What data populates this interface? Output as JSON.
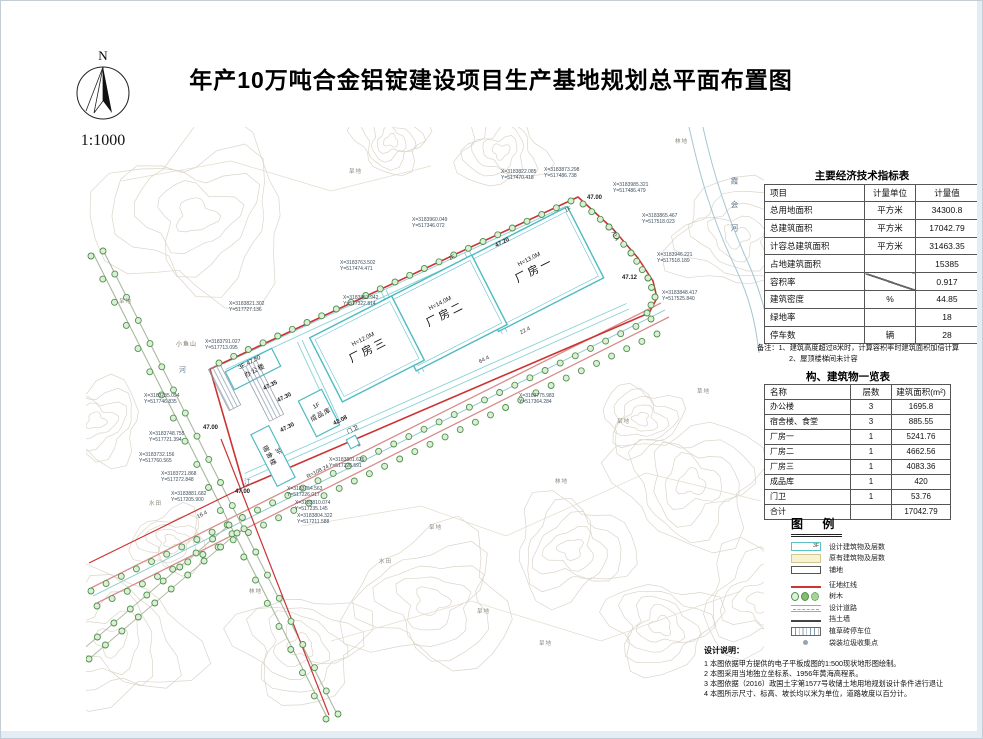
{
  "title": "年产10万吨合金铝锭建设项目生产基地规划总平面布置图",
  "compass": {
    "north_label": "N",
    "scale": "1:1000"
  },
  "econ_table": {
    "title": "主要经济技术指标表",
    "headers": [
      "项目",
      "计量单位",
      "计量值"
    ],
    "rows": [
      {
        "name": "总用地面积",
        "unit": "平方米",
        "value": "34300.8"
      },
      {
        "name": "总建筑面积",
        "unit": "平方米",
        "value": "17042.79"
      },
      {
        "name": "计容总建筑面积",
        "unit": "平方米",
        "value": "31463.35"
      },
      {
        "name": "占地建筑面积",
        "unit": "",
        "value": "15385"
      },
      {
        "name": "容积率",
        "unit": "DIAG",
        "value": "0.917"
      },
      {
        "name": "建筑密度",
        "unit": "%",
        "value": "44.85"
      },
      {
        "name": "绿地率",
        "unit": "",
        "value": "18"
      },
      {
        "name": "停车数",
        "unit": "辆",
        "value": "28"
      }
    ],
    "notes": [
      "备注：1、建筑高度超过8米时，计算容积率时建筑面积加倍计算",
      "2、屋顶楼梯间未计容"
    ]
  },
  "building_table": {
    "title": "构、建筑物一览表",
    "headers": [
      "名称",
      "层数",
      "建筑面积(m²)"
    ],
    "rows": [
      {
        "name": "办公楼",
        "floors": "3",
        "area": "1695.8"
      },
      {
        "name": "宿舍楼、食堂",
        "floors": "3",
        "area": "885.55"
      },
      {
        "name": "厂房一",
        "floors": "1",
        "area": "5241.76"
      },
      {
        "name": "厂房二",
        "floors": "1",
        "area": "4662.56"
      },
      {
        "name": "厂房三",
        "floors": "1",
        "area": "4083.36"
      },
      {
        "name": "成品库",
        "floors": "1",
        "area": "420"
      },
      {
        "name": "门卫",
        "floors": "1",
        "area": "53.76"
      },
      {
        "name": "合计",
        "floors": "",
        "area": "17042.79"
      }
    ]
  },
  "legend": {
    "title": "图 例",
    "items": [
      {
        "label": "设计建筑物及层数",
        "swatch_text": "3F"
      },
      {
        "label": "原有建筑物及层数"
      },
      {
        "label": "铺地"
      },
      {
        "label": "征地红线"
      },
      {
        "label": "树木"
      },
      {
        "label": "设计道路"
      },
      {
        "label": "挡土墙"
      },
      {
        "label": "植草砖停车位"
      },
      {
        "label": "袋装垃圾收集点"
      }
    ]
  },
  "notes": {
    "title": "设计说明：",
    "lines": [
      "1 本图依据甲方提供的电子平板成图的1:500现状地形图绘制。",
      "2 本图采用当地独立坐标系、1956年黄海高程系。",
      "3 本图依据（2016）政国土字第1577号收储土地用地规划设计条件进行退让",
      "4 本图所示尺寸、标高、坡长均以米为单位，道路坡度以百分计。"
    ]
  },
  "plan": {
    "buildings": [
      {
        "name": "厂房一",
        "height": "H=13.0M"
      },
      {
        "name": "厂房二",
        "height": "H=14.0M"
      },
      {
        "name": "厂房三",
        "height": "H=12.0M"
      },
      {
        "name": "办公楼",
        "floors": "3F",
        "elev": "47.80"
      },
      {
        "name": "宿舍楼",
        "floors": "3F"
      },
      {
        "name": "成品库",
        "floors": "1F"
      },
      {
        "name": "门卫",
        "floors": "1F"
      }
    ],
    "river_name": "霞会河",
    "hill_name": {
      "x": 175,
      "y": 338,
      "t": "小鱼山"
    },
    "stream_labels": [
      {
        "x": 178,
        "y": 364,
        "t": "河"
      },
      {
        "x": 243,
        "y": 476,
        "t": "江"
      }
    ],
    "coordinates": [
      {
        "x": 500,
        "y": 168,
        "X": "X=3183822.085",
        "Y": "Y=517470.418"
      },
      {
        "x": 543,
        "y": 166,
        "X": "X=3183873.298",
        "Y": "Y=517486.738"
      },
      {
        "x": 612,
        "y": 181,
        "X": "X=3183985.321",
        "Y": "Y=517486.479"
      },
      {
        "x": 641,
        "y": 212,
        "X": "X=3183865.467",
        "Y": "Y=517518.023"
      },
      {
        "x": 656,
        "y": 251,
        "X": "X=3183946.221",
        "Y": "Y=517518.189"
      },
      {
        "x": 661,
        "y": 289,
        "X": "X=3183848.417",
        "Y": "Y=517525.840"
      },
      {
        "x": 411,
        "y": 216,
        "X": "X=3183960.049",
        "Y": "Y=517346.072"
      },
      {
        "x": 339,
        "y": 259,
        "X": "X=3183763.502",
        "Y": "Y=517474.471"
      },
      {
        "x": 342,
        "y": 294,
        "X": "X=3183853.942",
        "Y": "Y=517322.814"
      },
      {
        "x": 518,
        "y": 392,
        "X": "X=3183775.983",
        "Y": "Y=517364.284"
      },
      {
        "x": 148,
        "y": 430,
        "X": "X=3183748.755",
        "Y": "Y=517721.394"
      },
      {
        "x": 138,
        "y": 451,
        "X": "X=3183732.156",
        "Y": "Y=517760.565"
      },
      {
        "x": 160,
        "y": 470,
        "X": "X=3183721.868",
        "Y": "Y=517272.848"
      },
      {
        "x": 170,
        "y": 490,
        "X": "X=3183881.682",
        "Y": "Y=517205.900"
      },
      {
        "x": 286,
        "y": 485,
        "X": "X=3183754.563",
        "Y": "Y=517226.017"
      },
      {
        "x": 294,
        "y": 499,
        "X": "X=3183810.074",
        "Y": "Y=517235.145"
      },
      {
        "x": 296,
        "y": 512,
        "X": "X=3183804.322",
        "Y": "Y=517211.588"
      },
      {
        "x": 328,
        "y": 456,
        "X": "X=3183801.626",
        "Y": "Y=517226.591"
      },
      {
        "x": 228,
        "y": 300,
        "X": "X=3183821.302",
        "Y": "Y=517727.136"
      },
      {
        "x": 204,
        "y": 338,
        "X": "X=3183791.027",
        "Y": "Y=517713.095"
      },
      {
        "x": 143,
        "y": 392,
        "X": "X=3183735.094",
        "Y": "Y=517746.835"
      }
    ],
    "elevations": [
      {
        "x": 586,
        "y": 194,
        "t": "47.00"
      },
      {
        "x": 494,
        "y": 239,
        "t": "47.20",
        "r": -27
      },
      {
        "x": 621,
        "y": 274,
        "t": "47.12"
      },
      {
        "x": 262,
        "y": 382,
        "t": "47.35",
        "r": -27
      },
      {
        "x": 276,
        "y": 394,
        "t": "47.30",
        "r": -27
      },
      {
        "x": 279,
        "y": 424,
        "t": "47.30",
        "r": -27
      },
      {
        "x": 202,
        "y": 424,
        "t": "47.00"
      },
      {
        "x": 234,
        "y": 488,
        "t": "47.00"
      },
      {
        "x": 332,
        "y": 417,
        "t": "42.08",
        "r": -27
      }
    ],
    "road_labels": [
      {
        "x": 608,
        "y": 232,
        "t": "70.4",
        "r": 63
      },
      {
        "x": 478,
        "y": 356,
        "t": "64.4",
        "r": -27
      },
      {
        "x": 519,
        "y": 327,
        "t": "22.4",
        "r": -27
      },
      {
        "x": 305,
        "y": 468,
        "t": "R=108.24",
        "r": -27
      },
      {
        "x": 196,
        "y": 511,
        "t": "16.4",
        "r": -27
      },
      {
        "x": 564,
        "y": 206,
        "t": "1F",
        "r": -27
      },
      {
        "x": 448,
        "y": 254,
        "t": "1F",
        "r": -27
      }
    ],
    "terrain_labels": [
      {
        "x": 428,
        "y": 522,
        "t": "旱地"
      },
      {
        "x": 554,
        "y": 476,
        "t": "林地"
      },
      {
        "x": 378,
        "y": 556,
        "t": "水田"
      },
      {
        "x": 616,
        "y": 416,
        "t": "旱地"
      },
      {
        "x": 696,
        "y": 386,
        "t": "草地"
      },
      {
        "x": 476,
        "y": 606,
        "t": "旱地"
      },
      {
        "x": 248,
        "y": 586,
        "t": "林地"
      },
      {
        "x": 118,
        "y": 296,
        "t": "旱地"
      },
      {
        "x": 674,
        "y": 136,
        "t": "林地"
      },
      {
        "x": 348,
        "y": 166,
        "t": "旱地"
      },
      {
        "x": 538,
        "y": 638,
        "t": "旱地"
      },
      {
        "x": 148,
        "y": 498,
        "t": "水田"
      }
    ]
  }
}
